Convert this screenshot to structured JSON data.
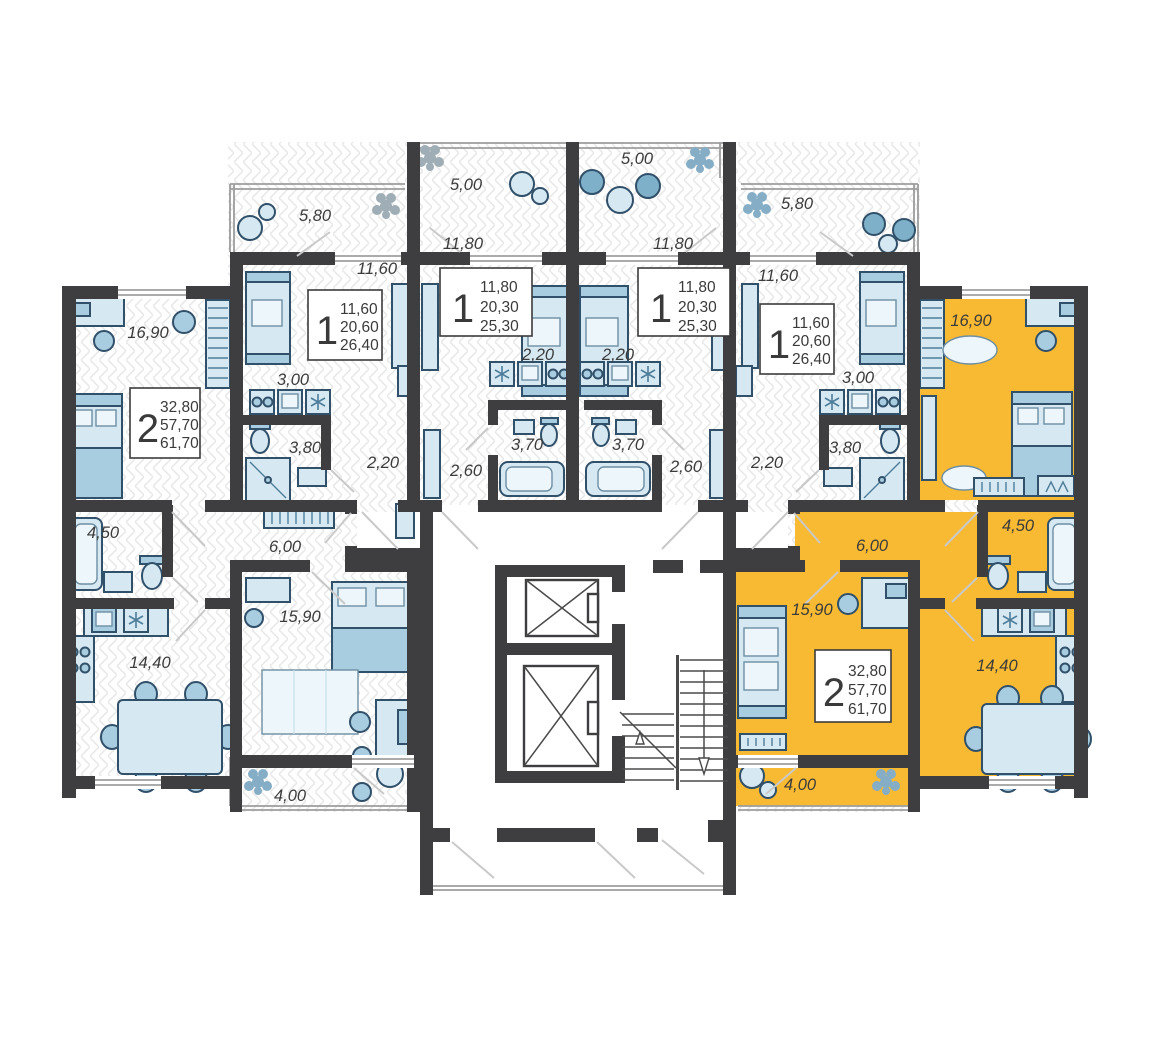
{
  "plan_type": "residential-floor-plan",
  "colors": {
    "highlight": "#F9BA33",
    "wall": "#3E3E40",
    "furniture_light": "#D6E9F3",
    "furniture_mid": "#A9CDE0",
    "furniture_dark": "#7FB0C9",
    "floor_hatch": "#E7E7E7"
  },
  "icons": [
    "flower-icon",
    "jug-icon",
    "sofa-icon",
    "bed-icon",
    "bathtub-icon",
    "shower-icon",
    "toilet-icon",
    "sink-icon",
    "stove-icon",
    "washer-icon",
    "dining-table-icon",
    "chair-icon",
    "piano-icon",
    "wardrobe-icon",
    "coat-rack-icon",
    "hanger-icon",
    "desk-icon",
    "rug-icon",
    "elevator-icon",
    "stairs-icon"
  ],
  "apartments": [
    {
      "id": "left-2room",
      "highlighted": false,
      "info": {
        "rooms": "2",
        "living": "32,80",
        "area": "57,70",
        "total": "61,70"
      },
      "rooms": [
        {
          "label": "16,90"
        },
        {
          "label": "4,50"
        },
        {
          "label": "14,40"
        },
        {
          "label": "15,90"
        },
        {
          "label": "6,00"
        },
        {
          "label": "4,00"
        }
      ]
    },
    {
      "id": "left-1room",
      "highlighted": false,
      "info": {
        "rooms": "1",
        "living": "11,60",
        "area": "20,60",
        "total": "26,40"
      },
      "rooms": [
        {
          "label": "5,80"
        },
        {
          "label": "11,60"
        },
        {
          "label": "3,00"
        },
        {
          "label": "3,80"
        },
        {
          "label": "2,20"
        }
      ]
    },
    {
      "id": "center-left-1room",
      "highlighted": false,
      "info": {
        "rooms": "1",
        "living": "11,80",
        "area": "20,30",
        "total": "25,30"
      },
      "rooms": [
        {
          "label": "5,00"
        },
        {
          "label": "11,80"
        },
        {
          "label": "2,20"
        },
        {
          "label": "3,70"
        },
        {
          "label": "2,60"
        }
      ]
    },
    {
      "id": "center-right-1room",
      "highlighted": false,
      "info": {
        "rooms": "1",
        "living": "11,80",
        "area": "20,30",
        "total": "25,30"
      },
      "rooms": [
        {
          "label": "5,00"
        },
        {
          "label": "11,80"
        },
        {
          "label": "2,20"
        },
        {
          "label": "3,70"
        },
        {
          "label": "2,60"
        }
      ]
    },
    {
      "id": "right-1room",
      "highlighted": false,
      "info": {
        "rooms": "1",
        "living": "11,60",
        "area": "20,60",
        "total": "26,40"
      },
      "rooms": [
        {
          "label": "5,80"
        },
        {
          "label": "11,60"
        },
        {
          "label": "3,00"
        },
        {
          "label": "3,80"
        },
        {
          "label": "2,20"
        }
      ]
    },
    {
      "id": "right-2room",
      "highlighted": true,
      "info": {
        "rooms": "2",
        "living": "32,80",
        "area": "57,70",
        "total": "61,70"
      },
      "rooms": [
        {
          "label": "16,90"
        },
        {
          "label": "4,50"
        },
        {
          "label": "14,40"
        },
        {
          "label": "15,90"
        },
        {
          "label": "6,00"
        },
        {
          "label": "4,00"
        }
      ]
    }
  ]
}
